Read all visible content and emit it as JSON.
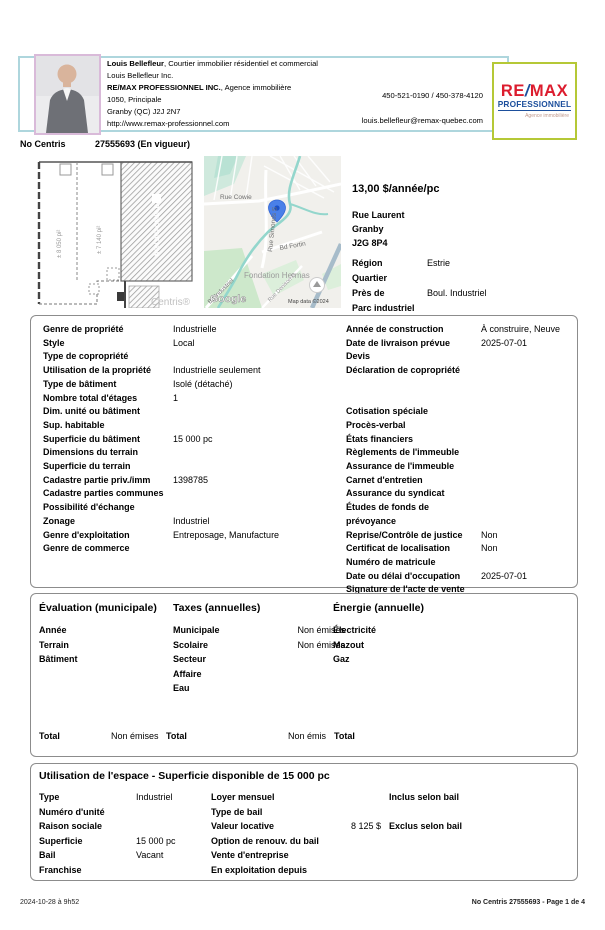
{
  "colors": {
    "remax_red": "#DC1C2E",
    "remax_blue": "#1D4F9C",
    "header_border": "#AED6DD",
    "photo_border": "#D9BAD9",
    "logo_border": "#B5C836",
    "map_pin": "#4A80E8"
  },
  "header": {
    "agent_lines": [
      {
        "b": "Louis Bellefleur",
        "r": ", Courtier immobilier résidentiel et commercial"
      },
      {
        "b": "",
        "r": "Louis Bellefleur Inc."
      },
      {
        "b": "RE/MAX PROFESSIONNEL INC.",
        "r": ", Agence immobilière"
      },
      {
        "b": "",
        "r": "1050, Principale"
      },
      {
        "b": "",
        "r": "Granby (QC) J2J 2N7"
      },
      {
        "b": "",
        "r": "http://www.remax-professionnel.com"
      }
    ],
    "phones": "450-521-0190 / 450-378-4120",
    "email": "louis.bellefleur@remax-quebec.com",
    "logo": {
      "re": "RE",
      "slash": "/",
      "max": "MAX",
      "line2": "PROFESSIONNEL",
      "line3": "Agence immobilière"
    }
  },
  "listing": {
    "label": "No Centris",
    "number_status": "27555693 (En vigueur)"
  },
  "plan": {
    "left_area": "± 8 050 pi²",
    "mid_area": "± 7 140 pi²",
    "na": "NON DISPONIBLE",
    "watermark": "Centris®"
  },
  "map": {
    "labels": {
      "cowie": "Rue Cowie",
      "simonds": "Rue Simonds S",
      "fortin": "Bd Fortin",
      "hermas": "Fondation Hermas",
      "industriel": "Bd Industriel",
      "denison": "Rue Denison O",
      "google": "Google",
      "copyright": "Map data ©2024"
    }
  },
  "price_block": {
    "price": "13,00 $/année/pc",
    "address": "Rue Laurent",
    "city": "Granby",
    "postal": "J2G 8P4",
    "fields": [
      {
        "label": "Région",
        "value": "Estrie"
      },
      {
        "label": "Quartier",
        "value": ""
      },
      {
        "label": "Près de",
        "value": "Boul. Industriel"
      },
      {
        "label": "Parc industriel",
        "value": ""
      }
    ]
  },
  "details": {
    "left": [
      {
        "label": "Genre de propriété",
        "value": "Industrielle"
      },
      {
        "label": "Style",
        "value": "Local"
      },
      {
        "label": "Type de copropriété",
        "value": ""
      },
      {
        "label": "Utilisation de la propriété",
        "value": "Industrielle seulement"
      },
      {
        "label": "Type de bâtiment",
        "value": "Isolé (détaché)"
      },
      {
        "label": "Nombre total d'étages",
        "value": "1"
      },
      {
        "label": "Dim. unité ou bâtiment",
        "value": ""
      },
      {
        "label": "Sup. habitable",
        "value": ""
      },
      {
        "label": "Superficie du bâtiment",
        "value": "15 000 pc"
      },
      {
        "label": "Dimensions du terrain",
        "value": ""
      },
      {
        "label": "Superficie du terrain",
        "value": ""
      },
      {
        "label": "Cadastre partie priv./imm",
        "value": "1398785"
      },
      {
        "label": "Cadastre parties communes",
        "value": ""
      },
      {
        "label": "Possibilité d'échange",
        "value": ""
      },
      {
        "label": "Zonage",
        "value": "Industriel"
      },
      {
        "label": "Genre d'exploitation",
        "value": "Entreposage, Manufacture"
      },
      {
        "label": "Genre de commerce",
        "value": ""
      }
    ],
    "right": [
      {
        "label": "Année de construction",
        "value": "À construire, Neuve"
      },
      {
        "label": "Date de livraison prévue",
        "value": "2025-07-01"
      },
      {
        "label": "Devis",
        "value": ""
      },
      {
        "label": "Déclaration de copropriété",
        "value": ""
      },
      {
        "label": "",
        "value": ""
      },
      {
        "label": "",
        "value": ""
      },
      {
        "label": "Cotisation spéciale",
        "value": ""
      },
      {
        "label": "Procès-verbal",
        "value": ""
      },
      {
        "label": "États financiers",
        "value": ""
      },
      {
        "label": "Règlements de l'immeuble",
        "value": ""
      },
      {
        "label": "Assurance de l'immeuble",
        "value": ""
      },
      {
        "label": "Carnet d'entretien",
        "value": ""
      },
      {
        "label": "Assurance du syndicat",
        "value": ""
      },
      {
        "label": "Études de fonds de prévoyance",
        "value": ""
      },
      {
        "label": "Reprise/Contrôle de justice",
        "value": "Non"
      },
      {
        "label": "Certificat de localisation",
        "value": "Non"
      },
      {
        "label": "Numéro de matricule",
        "value": ""
      },
      {
        "label": "Date ou délai d'occupation",
        "value": "2025-07-01"
      },
      {
        "label": "Signature de l'acte de vente",
        "value": ""
      }
    ]
  },
  "evaluation": {
    "col1": {
      "heading": "Évaluation (municipale)",
      "rows": [
        {
          "label": "Année",
          "value": ""
        },
        {
          "label": "Terrain",
          "value": ""
        },
        {
          "label": "Bâtiment",
          "value": ""
        }
      ]
    },
    "col2": {
      "heading": "Taxes (annuelles)",
      "rows": [
        {
          "label": "Municipale",
          "value": "Non émises"
        },
        {
          "label": "Scolaire",
          "value": "Non émises"
        },
        {
          "label": "Secteur",
          "value": ""
        },
        {
          "label": "Affaire",
          "value": ""
        },
        {
          "label": "Eau",
          "value": ""
        }
      ]
    },
    "col3": {
      "heading": "Énergie (annuelle)",
      "rows": [
        {
          "label": "Électricité",
          "value": ""
        },
        {
          "label": "Mazout",
          "value": ""
        },
        {
          "label": "Gaz",
          "value": ""
        }
      ]
    },
    "totals": {
      "t1_label": "Total",
      "t1_value": "Non émises",
      "t2_label": "Total",
      "t2_value": "Non émis",
      "t3_label": "Total",
      "t3_value": ""
    }
  },
  "usage": {
    "title": "Utilisation de l'espace - Superficie disponible de 15 000 pc",
    "rows": [
      {
        "l1": "Type",
        "v1": "Industriel",
        "l2": "Loyer mensuel",
        "v2": "",
        "note": "Inclus selon bail"
      },
      {
        "l1": "Numéro d'unité",
        "v1": "",
        "l2": "Type de bail",
        "v2": "",
        "note": ""
      },
      {
        "l1": "Raison sociale",
        "v1": "",
        "l2": "Valeur locative",
        "v2": "8 125 $",
        "note": "Exclus selon bail"
      },
      {
        "l1": "Superficie",
        "v1": "15 000 pc",
        "l2": "Option de renouv. du bail",
        "v2": "",
        "note": ""
      },
      {
        "l1": "Bail",
        "v1": "Vacant",
        "l2": "Vente d'entreprise",
        "v2": "",
        "note": ""
      },
      {
        "l1": "Franchise",
        "v1": "",
        "l2": "En exploitation depuis",
        "v2": "",
        "note": ""
      }
    ]
  },
  "footer": {
    "left": "2024-10-28 à 9h52",
    "right": "No Centris 27555693 - Page 1 de 4"
  }
}
